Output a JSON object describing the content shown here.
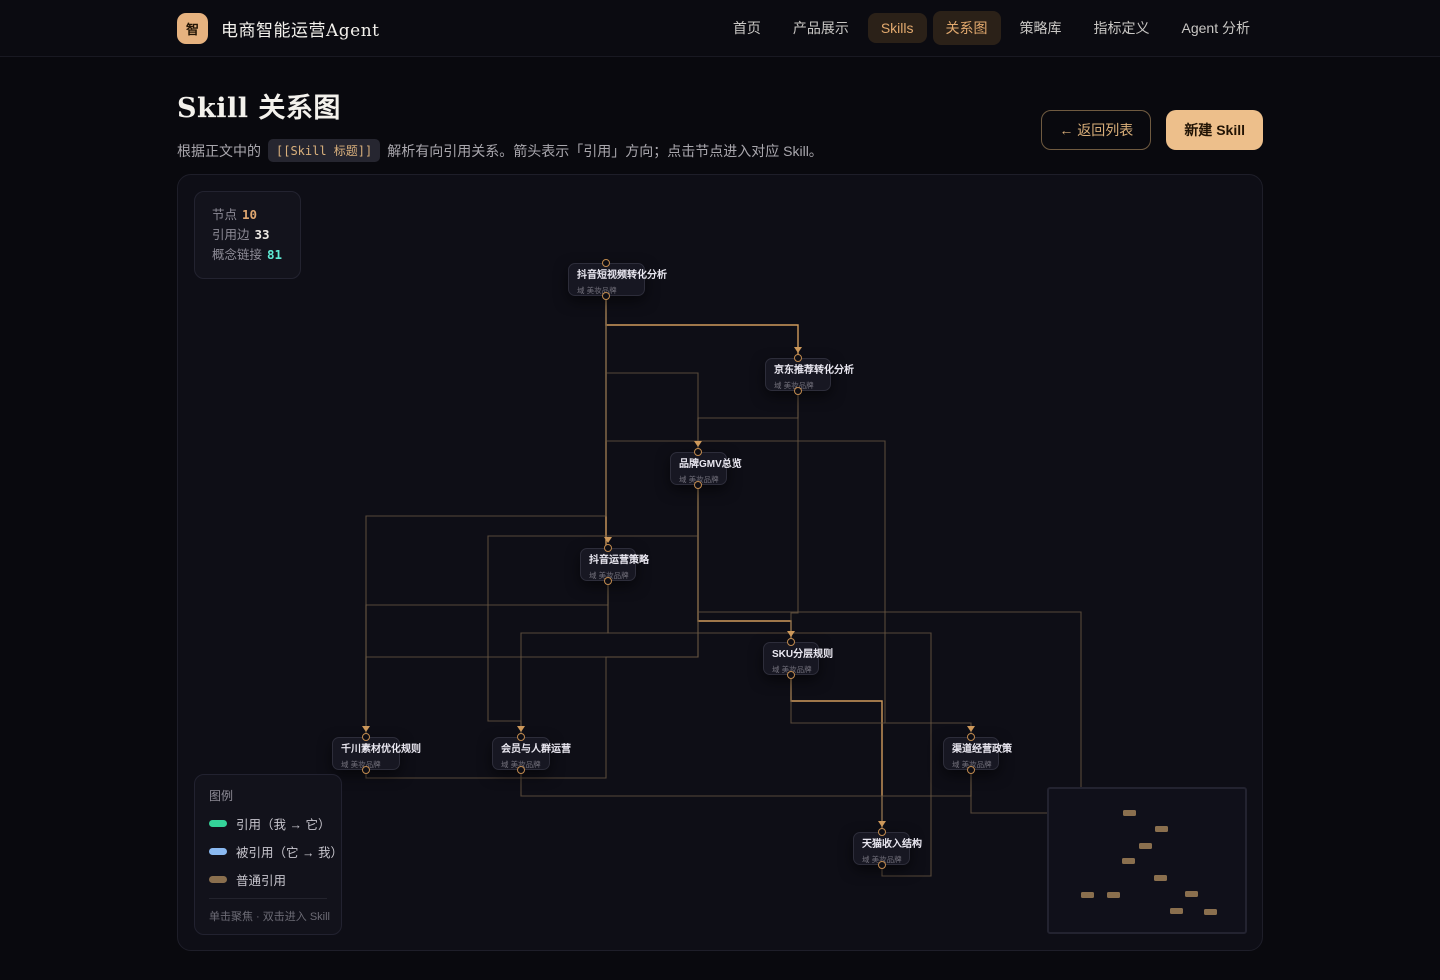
{
  "header": {
    "logo_glyph": "智",
    "brand": "电商智能运营Agent",
    "nav": [
      {
        "label": "首页",
        "active": false
      },
      {
        "label": "产品展示",
        "active": false
      },
      {
        "label": "Skills",
        "active": true
      },
      {
        "label": "关系图",
        "active": true
      },
      {
        "label": "策略库",
        "active": false
      },
      {
        "label": "指标定义",
        "active": false
      },
      {
        "label": "Agent 分析",
        "active": false
      }
    ]
  },
  "page": {
    "title": "Skill 关系图",
    "desc_prefix": "根据正文中的",
    "desc_badge": "[[Skill 标题]]",
    "desc_suffix": "解析有向引用关系。箭头表示「引用」方向；点击节点进入对应 Skill。",
    "back_button": "← 返回列表",
    "new_button": "新建 Skill"
  },
  "stats": {
    "rows": [
      {
        "label": "节点",
        "value": "10",
        "color": "#e0a770"
      },
      {
        "label": "引用边",
        "value": "33",
        "color": "#ece9e4"
      },
      {
        "label": "概念链接",
        "value": "81",
        "color": "#5eead4"
      }
    ]
  },
  "legend": {
    "title": "图例",
    "items": [
      {
        "label": "引用（我 → 它）",
        "color": "#34d399"
      },
      {
        "label": "被引用（它 → 我）",
        "color": "#8ab9f1"
      },
      {
        "label": "普通引用",
        "color": "#8a6f4e"
      }
    ],
    "footer": "单击聚焦 · 双击进入 Skill"
  },
  "graph": {
    "offset": [
      177,
      174
    ],
    "edge_colors": {
      "bright": "#cf9a5c",
      "dim": "#6a5742"
    },
    "nodes": [
      {
        "label": "抖音短视频转化分析",
        "sub": "域 美妆品牌",
        "x": 567,
        "y": 262,
        "w": 77,
        "h": 33,
        "px": 605
      },
      {
        "label": "京东推荐转化分析",
        "sub": "域 美妆品牌",
        "x": 764,
        "y": 357,
        "w": 66,
        "h": 33,
        "px": 797
      },
      {
        "label": "品牌GMV总览",
        "sub": "域 美妆品牌",
        "x": 669,
        "y": 451,
        "w": 57,
        "h": 33,
        "px": 697
      },
      {
        "label": "抖音运营策略",
        "sub": "域 美妆品牌",
        "x": 579,
        "y": 547,
        "w": 56,
        "h": 33,
        "px": 607
      },
      {
        "label": "SKU分层规则",
        "sub": "域 美妆品牌",
        "x": 762,
        "y": 641,
        "w": 56,
        "h": 33,
        "px": 790
      },
      {
        "label": "千川素材优化规则",
        "sub": "域 美妆品牌",
        "x": 331,
        "y": 736,
        "w": 68,
        "h": 33,
        "px": 365
      },
      {
        "label": "会员与人群运营",
        "sub": "域 美妆品牌",
        "x": 491,
        "y": 736,
        "w": 58,
        "h": 33,
        "px": 520
      },
      {
        "label": "渠道经营政策",
        "sub": "域 美妆品牌",
        "x": 942,
        "y": 736,
        "w": 56,
        "h": 33,
        "px": 970
      },
      {
        "label": "天猫收入结构",
        "sub": "域 美妆品牌",
        "x": 852,
        "y": 831,
        "w": 57,
        "h": 33,
        "px": 881
      }
    ],
    "edges": [
      {
        "tone": "bright",
        "points": [
          [
            605,
            295
          ],
          [
            605,
            546
          ]
        ]
      },
      {
        "tone": "bright",
        "points": [
          [
            605,
            295
          ],
          [
            605,
            324
          ],
          [
            797,
            324
          ],
          [
            797,
            356
          ]
        ]
      },
      {
        "tone": "bright",
        "points": [
          [
            697,
            485
          ],
          [
            697,
            620
          ],
          [
            790,
            620
          ],
          [
            790,
            640
          ]
        ]
      },
      {
        "tone": "bright",
        "points": [
          [
            790,
            675
          ],
          [
            790,
            700
          ],
          [
            881,
            700
          ],
          [
            881,
            830
          ]
        ]
      },
      {
        "tone": "dim",
        "points": [
          [
            605,
            295
          ],
          [
            605,
            372
          ],
          [
            697,
            372
          ],
          [
            697,
            450
          ]
        ]
      },
      {
        "tone": "dim",
        "points": [
          [
            797,
            391
          ],
          [
            797,
            417
          ],
          [
            697,
            417
          ],
          [
            697,
            450
          ]
        ]
      },
      {
        "tone": "dim",
        "points": [
          [
            605,
            295
          ],
          [
            605,
            440
          ],
          [
            884,
            440
          ],
          [
            884,
            722
          ],
          [
            970,
            722
          ],
          [
            970,
            735
          ]
        ]
      },
      {
        "tone": "dim",
        "points": [
          [
            797,
            391
          ],
          [
            797,
            612
          ],
          [
            790,
            612
          ],
          [
            790,
            640
          ]
        ]
      },
      {
        "tone": "dim",
        "points": [
          [
            607,
            581
          ],
          [
            607,
            604
          ],
          [
            365,
            604
          ],
          [
            365,
            735
          ]
        ]
      },
      {
        "tone": "dim",
        "points": [
          [
            607,
            581
          ],
          [
            607,
            632
          ],
          [
            930,
            632
          ],
          [
            930,
            875
          ],
          [
            881,
            875
          ],
          [
            881,
            865
          ]
        ]
      },
      {
        "tone": "dim",
        "points": [
          [
            697,
            485
          ],
          [
            697,
            656
          ],
          [
            365,
            656
          ],
          [
            365,
            735
          ]
        ]
      },
      {
        "tone": "dim",
        "points": [
          [
            697,
            485
          ],
          [
            697,
            535
          ],
          [
            487,
            535
          ],
          [
            487,
            720
          ],
          [
            520,
            720
          ],
          [
            520,
            735
          ]
        ]
      },
      {
        "tone": "dim",
        "points": [
          [
            605,
            295
          ],
          [
            605,
            515
          ],
          [
            365,
            515
          ],
          [
            365,
            735
          ]
        ]
      },
      {
        "tone": "dim",
        "points": [
          [
            697,
            485
          ],
          [
            697,
            611
          ],
          [
            1080,
            611
          ],
          [
            1080,
            800
          ]
        ]
      },
      {
        "tone": "dim",
        "points": [
          [
            970,
            769
          ],
          [
            970,
            795
          ],
          [
            881,
            795
          ],
          [
            881,
            830
          ]
        ]
      },
      {
        "tone": "dim",
        "points": [
          [
            365,
            770
          ],
          [
            365,
            777
          ],
          [
            605,
            777
          ],
          [
            605,
            656
          ],
          [
            697,
            656
          ],
          [
            697,
            485
          ]
        ]
      },
      {
        "tone": "dim",
        "points": [
          [
            520,
            770
          ],
          [
            520,
            795
          ],
          [
            881,
            795
          ],
          [
            881,
            830
          ]
        ]
      },
      {
        "tone": "dim",
        "points": [
          [
            607,
            581
          ],
          [
            607,
            632
          ],
          [
            520,
            632
          ],
          [
            520,
            735
          ]
        ]
      },
      {
        "tone": "dim",
        "points": [
          [
            790,
            675
          ],
          [
            790,
            722
          ],
          [
            884,
            722
          ]
        ]
      },
      {
        "tone": "dim",
        "points": [
          [
            970,
            769
          ],
          [
            970,
            812
          ],
          [
            1080,
            812
          ]
        ]
      }
    ],
    "arrows": [
      [
        797,
        352
      ],
      [
        697,
        446
      ],
      [
        790,
        636
      ],
      [
        365,
        731
      ],
      [
        520,
        731
      ],
      [
        970,
        731
      ],
      [
        881,
        826
      ],
      [
        607,
        542
      ]
    ]
  },
  "minimap": {
    "origin": [
      1048,
      788
    ],
    "dots": [
      [
        1122,
        809
      ],
      [
        1154,
        825
      ],
      [
        1138,
        842
      ],
      [
        1121,
        857
      ],
      [
        1153,
        874
      ],
      [
        1080,
        891
      ],
      [
        1106,
        891
      ],
      [
        1184,
        890
      ],
      [
        1169,
        907
      ],
      [
        1203,
        908
      ]
    ]
  }
}
